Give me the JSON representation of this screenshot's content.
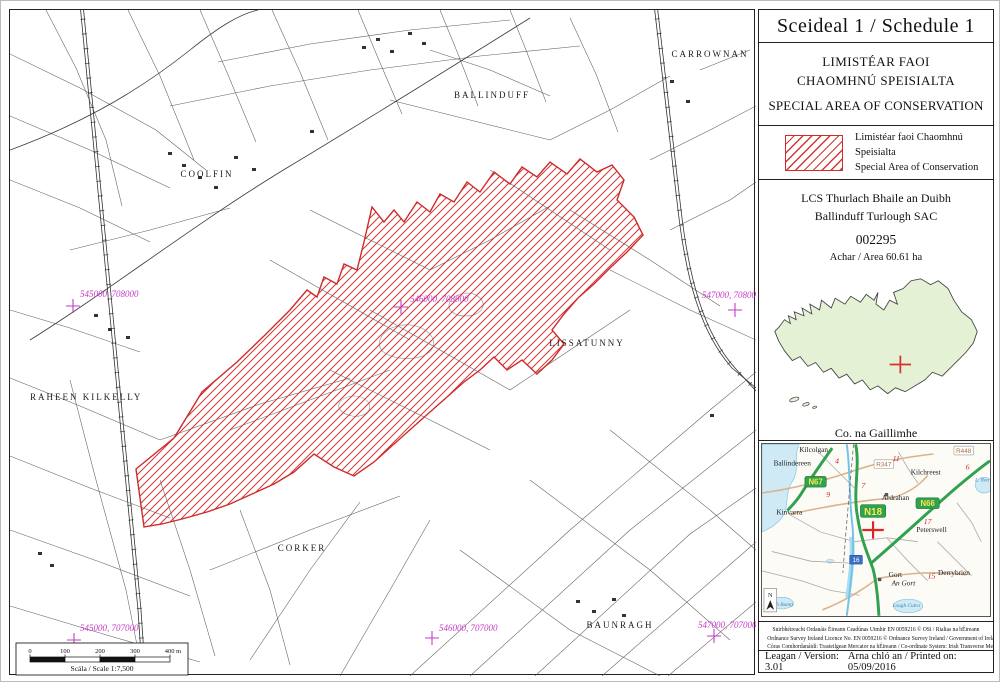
{
  "schedule": {
    "title": "Sceideal 1 / Schedule 1",
    "designation_ga_1": "LIMISTÉAR FAOI",
    "designation_ga_2": "CHAOMHNÚ SPEISIALTA",
    "designation_en": "SPECIAL AREA OF CONSERVATION",
    "legend": {
      "label_ga": "Limistéar faoi Chaomhnú Speisialta",
      "label_en": "Special Area of Conservation"
    },
    "site": {
      "name_ga": "LCS Thurlach Bhaile an Duibh",
      "name_en": "Ballinduff Turlough SAC",
      "code": "002295",
      "area_label": "Achar / Area 60.61 ha"
    },
    "county": {
      "name_ga": "Co. na Gaillimhe",
      "name_en": "Co. Galway"
    },
    "footnote_lines": [
      "Suirbhéireacht Ordanáis Éireann Ceadúnas Uimhir EN 0059216 © OSi / Rialtas na hÉireann",
      "Ordnance Survey Ireland Licence No. EN 0059216 © Ordnance Survey Ireland / Government of Ireland",
      "Córas Comhordanáidí: Trasteilgean Mercator na hÉireann / Co-ordinate System: Irish Transverse Mercator"
    ],
    "version_label": "Leagan / Version: 3.01",
    "printed_label": "Arna chló an / Printed on: 05/09/2016"
  },
  "map": {
    "placenames": [
      {
        "label": "COOLFIN"
      },
      {
        "label": "BALLINDUFF"
      },
      {
        "label": "CARROWNAN"
      },
      {
        "label": "LISSATUNNY"
      },
      {
        "label": "RAHEEN KILKELLY"
      },
      {
        "label": "CORKER"
      },
      {
        "label": "BAUNRAGH"
      }
    ],
    "coords": [
      {
        "label": "545000, 708000"
      },
      {
        "label": "546000, 708000"
      },
      {
        "label": "547000, 708000"
      },
      {
        "label": "545000, 707000"
      },
      {
        "label": "546000, 707000"
      },
      {
        "label": "547000, 707000"
      }
    ],
    "scalebar": {
      "ticks": [
        "0",
        "100",
        "200",
        "300",
        "400 m"
      ],
      "label": "Scála / Scale 1:7,500"
    }
  },
  "inset": {
    "towns": [
      "Kilcolgan",
      "Ballindereen",
      "Kinvarra",
      "Kilchreest",
      "Ardrahan",
      "Peterswell",
      "Gort",
      "An Gort",
      "Derrybrien"
    ],
    "water_labels": [
      "L. Rea",
      "Lough Bunny",
      "Lough Cutra"
    ],
    "shields": [
      "N67",
      "N18",
      "N66",
      "R347",
      "R448",
      "16"
    ],
    "distances": [
      "4",
      "9",
      "7",
      "11",
      "6",
      "17",
      "15"
    ]
  },
  "colors": {
    "sac_red": "#cf2b2b",
    "grid_magenta": "#c63bc6",
    "county_fill": "#e4f1d4",
    "national_road": "#2fa14f",
    "water": "#cfe9f5"
  }
}
